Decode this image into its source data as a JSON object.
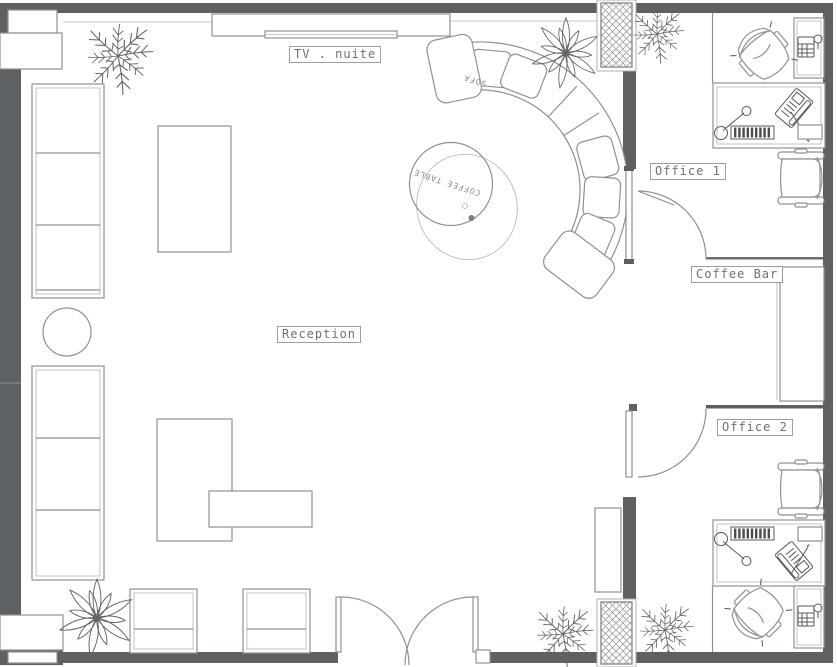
{
  "colors": {
    "wall": "#5d6163",
    "line": "#8e9295",
    "detail": "#55595c",
    "text": "#6e7072",
    "bg": "#ffffff"
  },
  "labels": {
    "tv_unit": "TV . nuite",
    "reception": "Reception",
    "office1": "Office 1",
    "coffee_bar": "Coffee Bar",
    "office2": "Office 2",
    "sofa": "SOFA",
    "coffee_table": "COFFEE TABLE"
  },
  "rooms": [
    {
      "name": "Reception"
    },
    {
      "name": "Office 1"
    },
    {
      "name": "Coffee Bar"
    },
    {
      "name": "Office 2"
    }
  ],
  "furniture": [
    {
      "name": "tv-console",
      "area": "reception"
    },
    {
      "name": "curved-sectional-sofa",
      "area": "reception"
    },
    {
      "name": "round-coffee-table",
      "area": "reception"
    },
    {
      "name": "wall-sofa-upper",
      "area": "reception"
    },
    {
      "name": "wall-sofa-lower",
      "area": "reception"
    },
    {
      "name": "round-side-table",
      "area": "reception"
    },
    {
      "name": "display-table-1",
      "area": "reception"
    },
    {
      "name": "display-table-2",
      "area": "reception"
    },
    {
      "name": "display-table-3",
      "area": "reception"
    },
    {
      "name": "armchair-1",
      "area": "reception"
    },
    {
      "name": "armchair-2",
      "area": "reception"
    },
    {
      "name": "double-entry-door",
      "area": "reception"
    },
    {
      "name": "office-desk",
      "area": "office-1"
    },
    {
      "name": "task-chair",
      "area": "office-1"
    },
    {
      "name": "side-chair",
      "area": "office-1"
    },
    {
      "name": "equipment-cabinet",
      "area": "office-1"
    },
    {
      "name": "swing-door",
      "area": "office-1"
    },
    {
      "name": "bar-counter",
      "area": "coffee-bar"
    },
    {
      "name": "office-desk",
      "area": "office-2"
    },
    {
      "name": "task-chair",
      "area": "office-2"
    },
    {
      "name": "side-chair",
      "area": "office-2"
    },
    {
      "name": "equipment-cabinet",
      "area": "office-2"
    },
    {
      "name": "swing-door",
      "area": "office-2"
    },
    {
      "name": "potted-palm",
      "count": 2
    },
    {
      "name": "fern-plant",
      "count": 4
    },
    {
      "name": "structural-column",
      "count": 2
    }
  ]
}
